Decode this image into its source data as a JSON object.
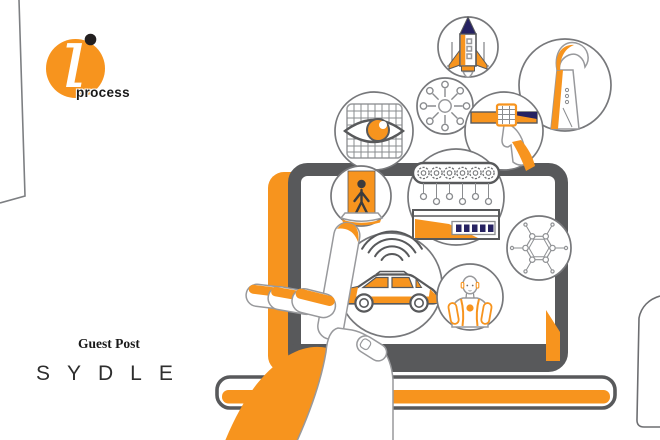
{
  "colors": {
    "orange": "#F7941E",
    "frame_gray": "#58595B",
    "outline_gray": "#8a8c8f",
    "navy": "#262262",
    "ink": "#1a1a1a"
  },
  "logo": {
    "brand": "iprocess",
    "mark_glyph": "ı",
    "wordmark": "process",
    "mark": "orange-circle-with-white-swoosh-and-black-dot"
  },
  "caption": {
    "label": "Guest Post",
    "brand": "SYDLE"
  },
  "illustration": {
    "subject": "hand-touching-laptop-touchscreen",
    "bubbles": [
      {
        "icon": "rocket-icon"
      },
      {
        "icon": "robotic-arm-icon"
      },
      {
        "icon": "network-hub-icon"
      },
      {
        "icon": "vision-eye-icon"
      },
      {
        "icon": "button-press-icon"
      },
      {
        "icon": "person-scanner-icon"
      },
      {
        "icon": "factory-automation-icon"
      },
      {
        "icon": "connected-car-icon"
      },
      {
        "icon": "humanoid-robot-icon"
      },
      {
        "icon": "molecule-network-icon"
      }
    ]
  }
}
